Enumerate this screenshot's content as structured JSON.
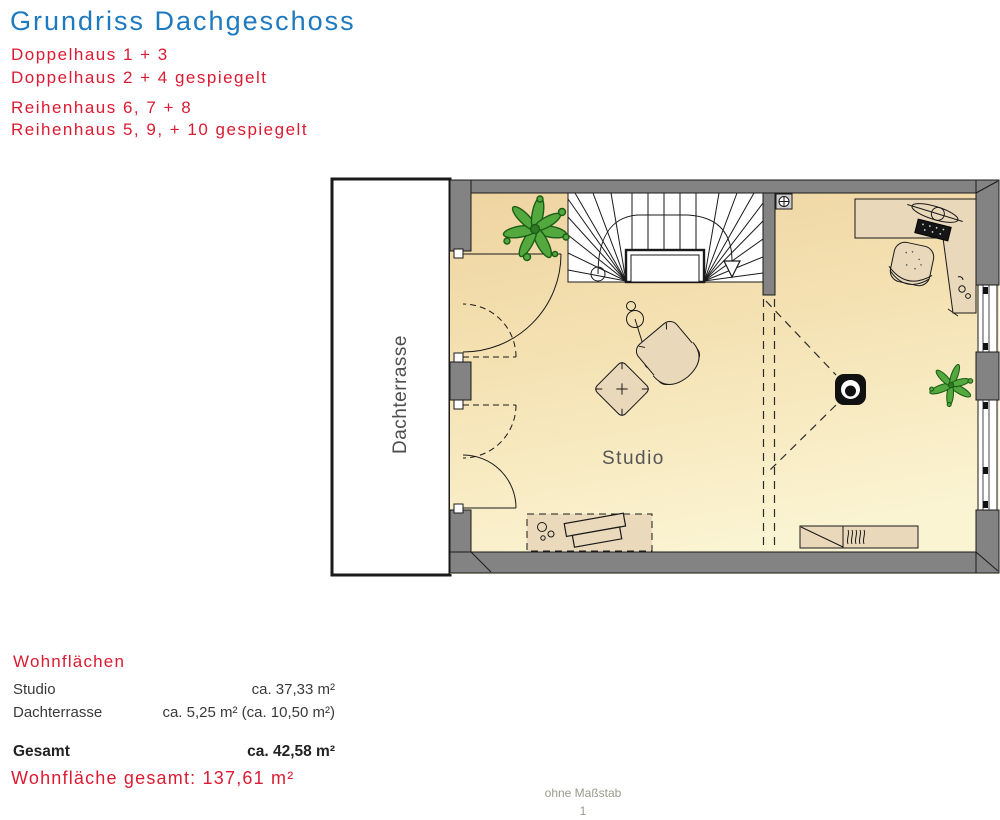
{
  "header": {
    "title": "Grundriss Dachgeschoss",
    "variants": [
      "Doppelhaus 1 + 3",
      "Doppelhaus 2 + 4 gespiegelt",
      "Reihenhaus 6, 7 + 8",
      "Reihenhaus 5, 9, + 10 gespiegelt"
    ]
  },
  "plan": {
    "terrace_label": "Dachterrasse",
    "room_label": "Studio"
  },
  "areas": {
    "heading": "Wohnflächen",
    "rows": [
      {
        "label": "Studio",
        "value": "ca. 37,33 m²"
      },
      {
        "label": "Dachterrasse",
        "value": "ca. 5,25 m² (ca. 10,50 m²)"
      }
    ],
    "total": {
      "label": "Gesamt",
      "value": "ca. 42,58 m²"
    },
    "grand_total": "Wohnfläche gesamt: 137,61 m²"
  },
  "footer": {
    "scale_note": "ohne Maßstab",
    "page_number": "1"
  },
  "colors": {
    "title_blue": "#1d79c0",
    "accent_red": "#dc1a32",
    "wall_gray": "#838383",
    "floor_tan_top": "#eed3a0",
    "floor_tan_bottom": "#fbf4d2",
    "furniture_tan": "#e9d8ba",
    "plant_green": "#53a93e"
  }
}
